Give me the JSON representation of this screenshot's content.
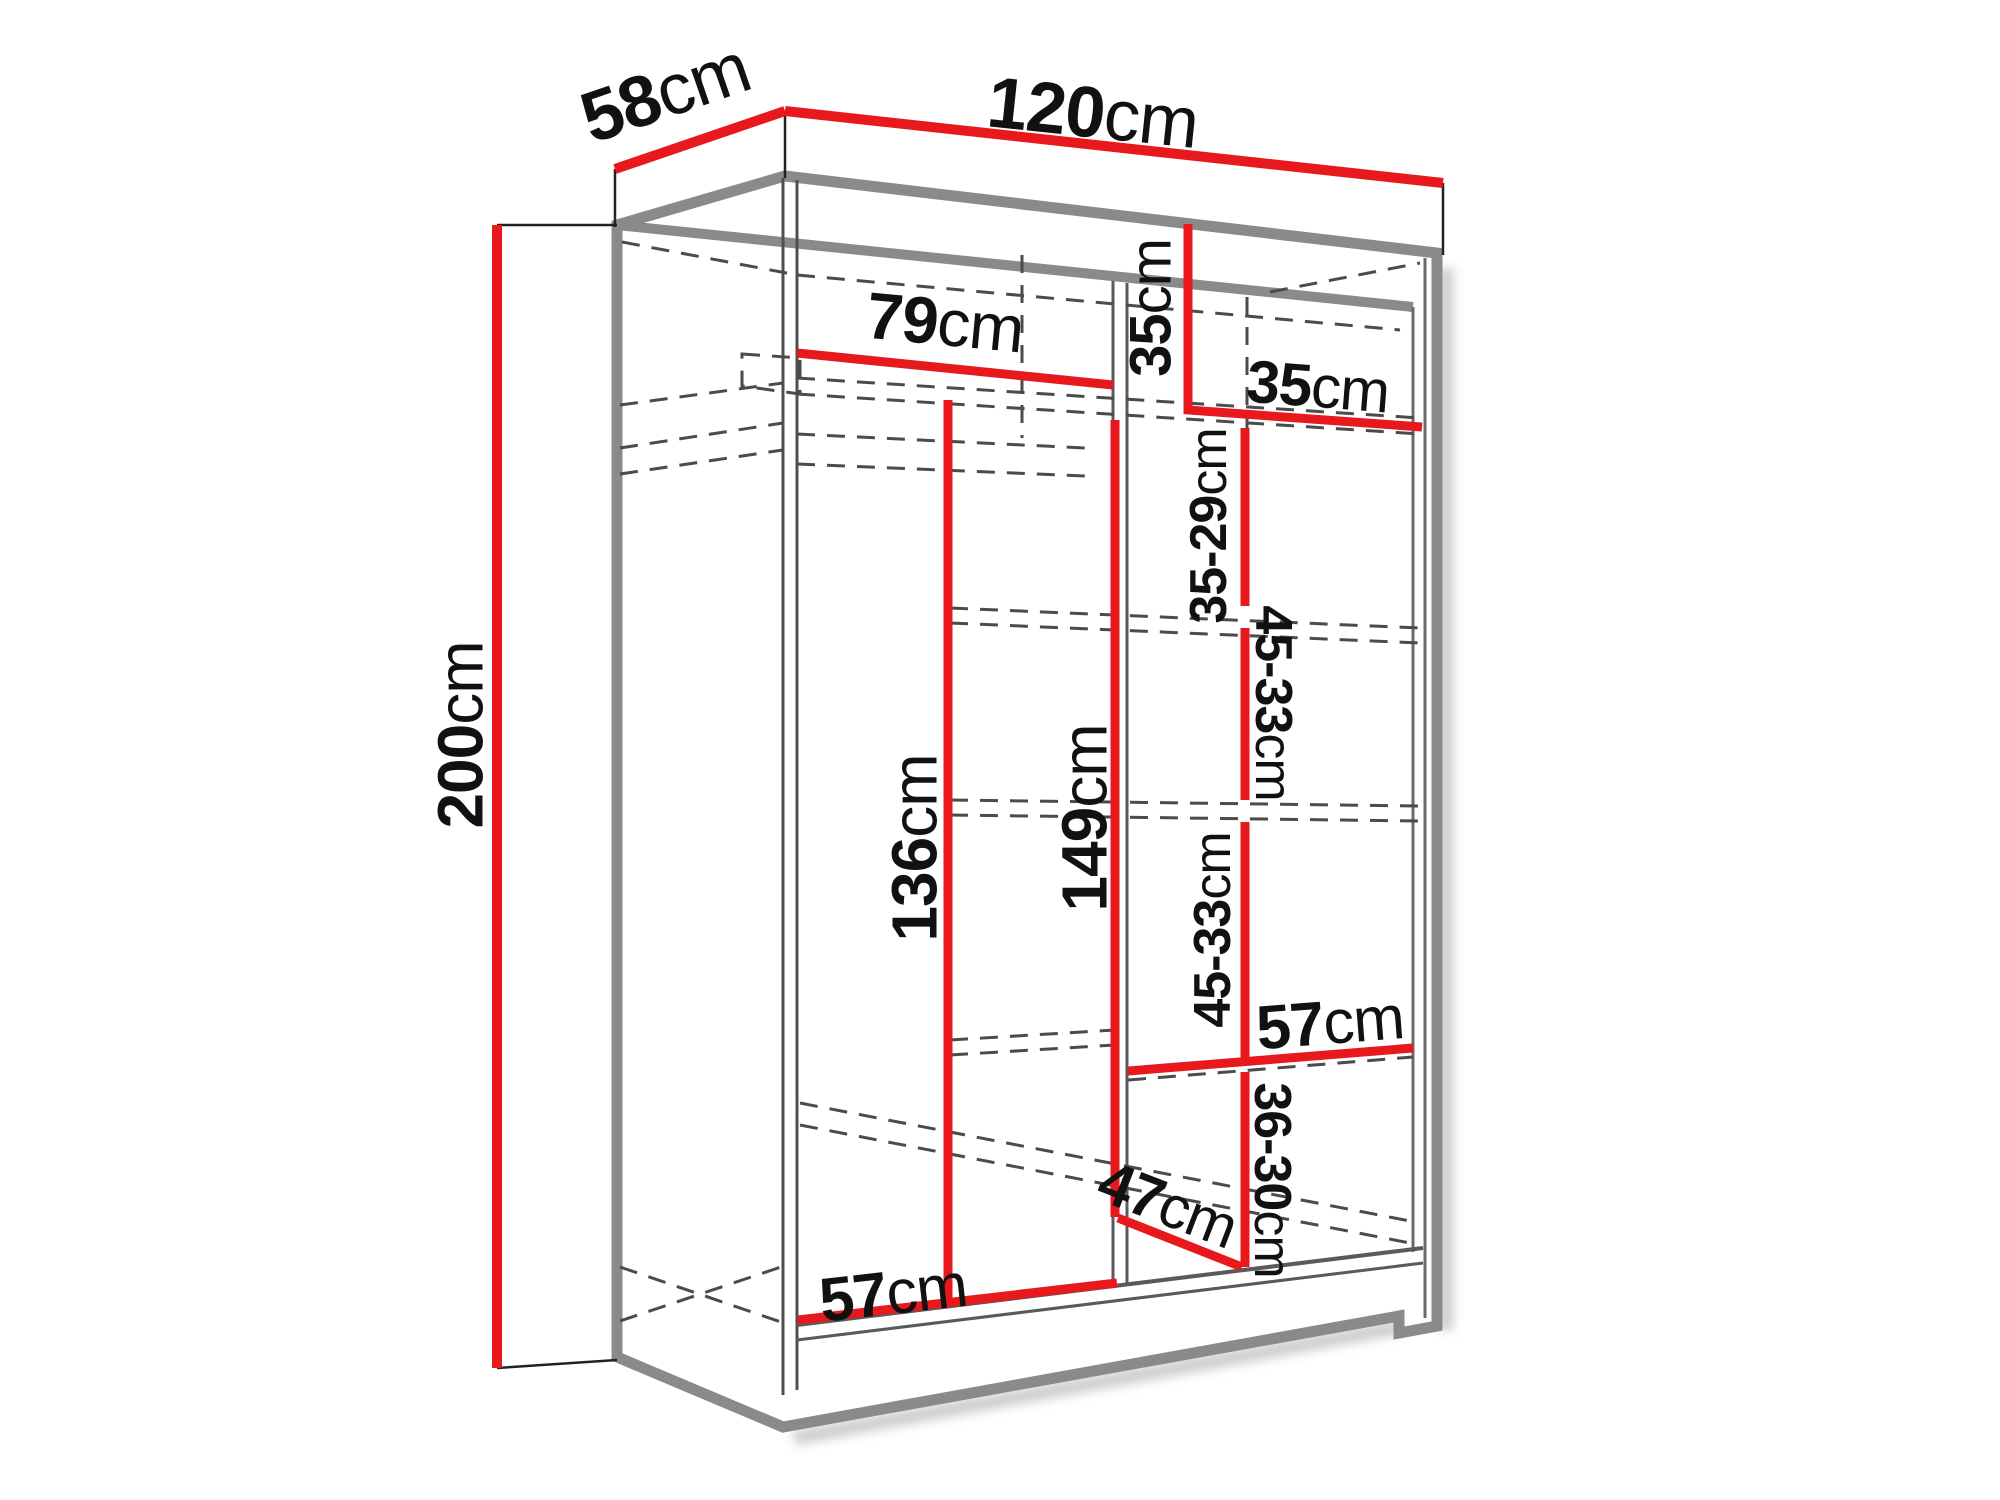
{
  "diagram": {
    "type": "furniture-dimension-drawing",
    "subject": "two-door wardrobe with shelves and hanging rail",
    "colors": {
      "dimension_line": "#e8191c",
      "carcass_edge": "#8a8a8a",
      "hidden_line": "#4b4b4b",
      "label_text": "#111111",
      "background": "#ffffff"
    },
    "dimensions": {
      "width": {
        "value": "120",
        "unit": "cm"
      },
      "depth": {
        "value": "58",
        "unit": "cm"
      },
      "height": {
        "value": "200",
        "unit": "cm"
      },
      "left_section_width": {
        "value": "79",
        "unit": "cm"
      },
      "top_section_height": {
        "value": "35",
        "unit": "cm"
      },
      "right_section_width": {
        "value": "35",
        "unit": "cm"
      },
      "shelf_gap_1": {
        "value": "35-29",
        "unit": "cm"
      },
      "shelf_gap_2": {
        "value": "45-33",
        "unit": "cm"
      },
      "shelf_gap_3": {
        "value": "45-33",
        "unit": "cm"
      },
      "hanging_space_height": {
        "value": "136",
        "unit": "cm"
      },
      "right_column_height": {
        "value": "149",
        "unit": "cm"
      },
      "right_shelf_width": {
        "value": "57",
        "unit": "cm"
      },
      "shelf_gap_4": {
        "value": "36-30",
        "unit": "cm"
      },
      "bottom_shelf_depth": {
        "value": "47",
        "unit": "cm"
      },
      "bottom_shelf_width": {
        "value": "57",
        "unit": "cm"
      }
    }
  }
}
